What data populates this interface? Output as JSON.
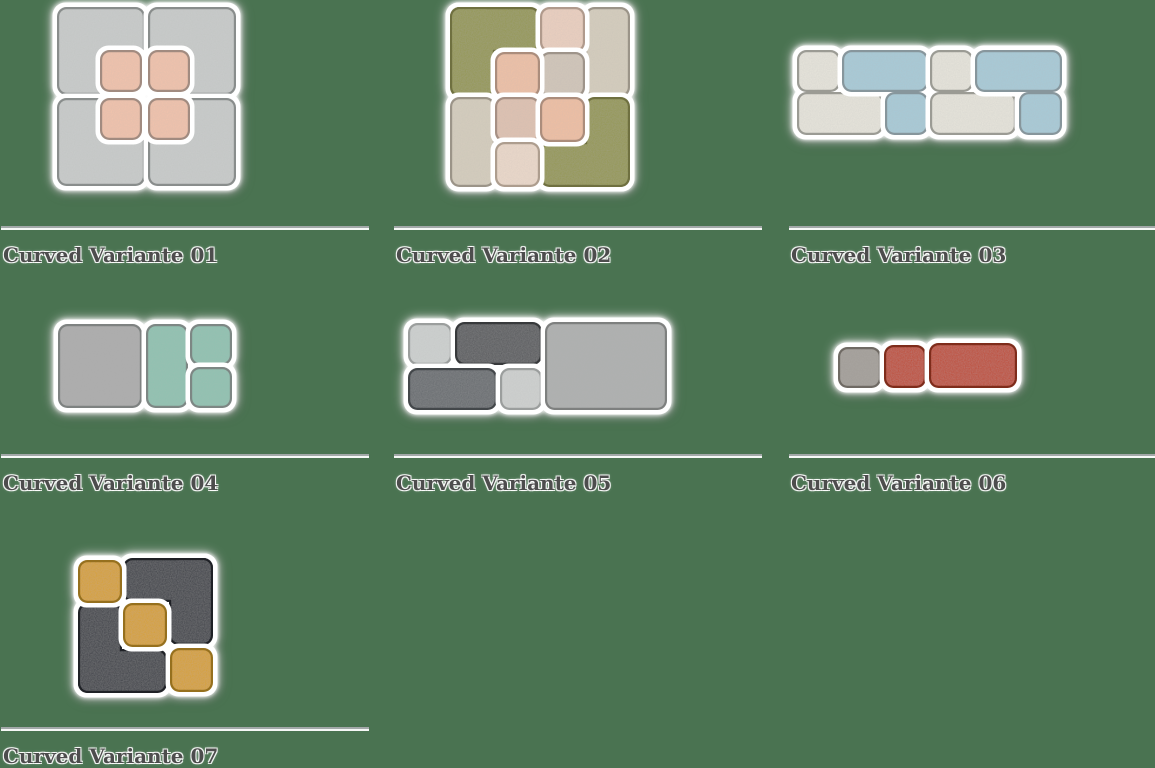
{
  "page": {
    "background": "#4a7351",
    "width": 1155,
    "height": 763,
    "description": "Grid of curved acoustic felt tile layout variants"
  },
  "divider": {
    "width": 368,
    "color": "#a2a8a8",
    "highlight": "#ffffff"
  },
  "caption_style": {
    "color": "#4d4d4d",
    "halo": "#ffffff"
  },
  "cards": [
    {
      "id": "curved-variante-01",
      "label": "Curved Variante 01",
      "col_x": 1,
      "divider_y": 226,
      "pieces": [
        {
          "name": "gray-square-top-left",
          "face": "#c9cccb",
          "edge": "#898d8c",
          "rects": [
            [
              57,
              7,
              88,
              88
            ]
          ]
        },
        {
          "name": "gray-square-top-right",
          "face": "#c9cccb",
          "edge": "#898d8c",
          "rects": [
            [
              148,
              7,
              88,
              88
            ]
          ]
        },
        {
          "name": "gray-square-bottom-left",
          "face": "#c9cccb",
          "edge": "#898d8c",
          "rects": [
            [
              57,
              98,
              88,
              88
            ]
          ]
        },
        {
          "name": "gray-square-bottom-right",
          "face": "#c9cccb",
          "edge": "#898d8c",
          "rects": [
            [
              148,
              98,
              88,
              88
            ]
          ]
        },
        {
          "name": "salmon-square-1",
          "face": "#f2c3ab",
          "edge": "#a18b80",
          "rects": [
            [
              100,
              50,
              42,
              42
            ]
          ]
        },
        {
          "name": "salmon-square-2",
          "face": "#f2c3ab",
          "edge": "#a18b80",
          "rects": [
            [
              148,
              50,
              42,
              42
            ]
          ]
        },
        {
          "name": "salmon-square-3",
          "face": "#f2c3ab",
          "edge": "#a18b80",
          "rects": [
            [
              100,
              98,
              42,
              42
            ]
          ]
        },
        {
          "name": "salmon-square-4",
          "face": "#f2c3ab",
          "edge": "#a18b80",
          "rects": [
            [
              148,
              98,
              42,
              42
            ]
          ]
        }
      ]
    },
    {
      "id": "curved-variante-02",
      "label": "Curved Variante 02",
      "col_x": 394,
      "divider_y": 226,
      "pieces": [
        {
          "name": "olive-l-top-left",
          "face": "#949751",
          "edge": "#6f7040",
          "rects": [
            [
              450,
              7,
              90,
              45
            ],
            [
              450,
              7,
              45,
              90
            ]
          ]
        },
        {
          "name": "beige-rect-top-right",
          "face": "#d6cebd",
          "edge": "#9b9488",
          "rects": [
            [
              585,
              7,
              45,
              90
            ]
          ]
        },
        {
          "name": "beige-rect-bottom-left",
          "face": "#d6cebd",
          "edge": "#9b9488",
          "rects": [
            [
              450,
              97,
              45,
              90
            ]
          ]
        },
        {
          "name": "olive-l-bottom-right",
          "face": "#949751",
          "edge": "#6f7040",
          "rects": [
            [
              585,
              97,
              45,
              90
            ],
            [
              540,
              142,
              90,
              45
            ]
          ]
        },
        {
          "name": "pink-square-top",
          "face": "#ecd0c0",
          "edge": "#b09a8c",
          "rects": [
            [
              540,
              7,
              45,
              45
            ]
          ]
        },
        {
          "name": "tan-square-mid-right",
          "face": "#d2c6b9",
          "edge": "#9e948a",
          "rects": [
            [
              540,
              52,
              45,
              45
            ]
          ]
        },
        {
          "name": "salmon-square-mid-left",
          "face": "#efc1a6",
          "edge": "#ab8d7c",
          "rects": [
            [
              495,
              52,
              45,
              45
            ]
          ]
        },
        {
          "name": "tan-square-center",
          "face": "#e0c2b1",
          "edge": "#a69084",
          "rects": [
            [
              495,
              97,
              45,
              45
            ]
          ]
        },
        {
          "name": "salmon-square-center-right",
          "face": "#f0bfa3",
          "edge": "#ab8d7c",
          "rects": [
            [
              540,
              97,
              45,
              45
            ]
          ]
        },
        {
          "name": "pink-square-bottom",
          "face": "#ecd9ca",
          "edge": "#ad9d8e",
          "rects": [
            [
              495,
              142,
              45,
              45
            ]
          ]
        }
      ]
    },
    {
      "id": "curved-variante-03",
      "label": "Curved Variante 03",
      "col_x": 789,
      "divider_y": 226,
      "pieces": [
        {
          "name": "cream-l-left",
          "face": "#e7e5dc",
          "edge": "#9b9b94",
          "rects": [
            [
              797,
              50,
              43,
              42
            ],
            [
              797,
              92,
              86,
              43
            ]
          ]
        },
        {
          "name": "blue-l-left",
          "face": "#a7cbd8",
          "edge": "#87969c",
          "rects": [
            [
              842,
              50,
              86,
              42
            ],
            [
              885,
              92,
              43,
              43
            ]
          ]
        },
        {
          "name": "cream-l-right",
          "face": "#e7e5dc",
          "edge": "#9b9b94",
          "rects": [
            [
              930,
              50,
              43,
              42
            ],
            [
              930,
              92,
              86,
              43
            ]
          ]
        },
        {
          "name": "blue-l-right",
          "face": "#a7cbd8",
          "edge": "#87969c",
          "rects": [
            [
              975,
              50,
              87,
              42
            ],
            [
              1019,
              92,
              43,
              43
            ]
          ]
        }
      ]
    },
    {
      "id": "curved-variante-04",
      "label": "Curved Variante 04",
      "col_x": 1,
      "divider_y": 454,
      "pieces": [
        {
          "name": "gray-large-square",
          "face": "#acacac",
          "edge": "#7e8281",
          "rects": [
            [
              58,
              324,
              84,
              84
            ]
          ]
        },
        {
          "name": "teal-tall-rect",
          "face": "#8ec3b1",
          "edge": "#7d8784",
          "rects": [
            [
              146,
              324,
              42,
              84
            ]
          ]
        },
        {
          "name": "teal-square-top",
          "face": "#8ec3b1",
          "edge": "#7d8784",
          "rects": [
            [
              190,
              324,
              42,
              41
            ]
          ]
        },
        {
          "name": "teal-square-bottom",
          "face": "#8ec3b1",
          "edge": "#7d8784",
          "rects": [
            [
              190,
              367,
              42,
              41
            ]
          ]
        }
      ]
    },
    {
      "id": "curved-variante-05",
      "label": "Curved Variante 05",
      "col_x": 394,
      "divider_y": 454,
      "pieces": [
        {
          "name": "light-square-top",
          "face": "#ced1d0",
          "edge": "#9b9e9d",
          "rects": [
            [
              408,
              323,
              44,
              42
            ]
          ]
        },
        {
          "name": "dark-rect-top",
          "face": "#57595b",
          "edge": "#37393b",
          "rects": [
            [
              455,
              322,
              87,
              43
            ]
          ]
        },
        {
          "name": "slate-rect-bottom",
          "face": "#666b6e",
          "edge": "#43474a",
          "rects": [
            [
              408,
              368,
              89,
              42
            ]
          ]
        },
        {
          "name": "light-square-bottom",
          "face": "#cfd1d0",
          "edge": "#9b9e9d",
          "rects": [
            [
              500,
              368,
              42,
              42
            ]
          ]
        },
        {
          "name": "gray-large-rect-right",
          "face": "#aeb0af",
          "edge": "#7e807f",
          "rects": [
            [
              545,
              322,
              122,
              88
            ]
          ]
        }
      ]
    },
    {
      "id": "curved-variante-06",
      "label": "Curved Variante 06",
      "col_x": 789,
      "divider_y": 454,
      "pieces": [
        {
          "name": "gray-square",
          "face": "#a39e98",
          "edge": "#6f6a64",
          "rects": [
            [
              838,
              347,
              43,
              41
            ]
          ]
        },
        {
          "name": "red-square",
          "face": "#bf4a32",
          "edge": "#7e2c1b",
          "rects": [
            [
              884,
              345,
              42,
              43
            ]
          ]
        },
        {
          "name": "red-wide-rect",
          "face": "#bf4a32",
          "edge": "#7e2c1b",
          "rects": [
            [
              929,
              343,
              88,
              45
            ]
          ]
        }
      ]
    },
    {
      "id": "curved-variante-07",
      "label": "Curved Variante 07",
      "col_x": 1,
      "divider_y": 727,
      "pieces": [
        {
          "name": "charcoal-l-top-right",
          "face": "#3b3e44",
          "edge": "#1f2126",
          "rects": [
            [
              123,
              558,
              90,
              44
            ],
            [
              169,
              558,
              44,
              87
            ]
          ]
        },
        {
          "name": "charcoal-l-bottom-left",
          "face": "#3b3e44",
          "edge": "#1f2126",
          "rects": [
            [
              78,
              603,
              44,
              90
            ],
            [
              78,
              649,
              89,
              44
            ]
          ]
        },
        {
          "name": "mustard-square-top-left",
          "face": "#d7a02c",
          "edge": "#96701e",
          "rects": [
            [
              78,
              560,
              44,
              43
            ]
          ]
        },
        {
          "name": "mustard-square-center",
          "face": "#d7a02c",
          "edge": "#96701e",
          "rects": [
            [
              123,
              603,
              44,
              44
            ]
          ]
        },
        {
          "name": "mustard-square-bottom-right",
          "face": "#d7a02c",
          "edge": "#96701e",
          "rects": [
            [
              170,
              648,
              43,
              44
            ]
          ]
        }
      ]
    }
  ]
}
